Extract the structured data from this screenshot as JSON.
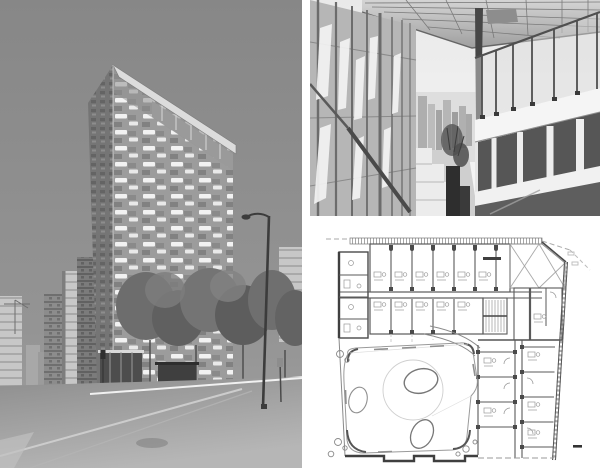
{
  "page": {
    "title": "Architecture project photo collage",
    "background": "#ffffff",
    "layout": "three-panel montage: street photo of tower (left), terrace facade photo (top right), floor plan drawing (bottom right)"
  },
  "panels": {
    "tower_photo": {
      "alt": "Black-and-white photograph of a tall residential tower seen corner-on against a grey sky; its facade is a checkerboard of openings with scattered white balcony slabs and a cantilevered white roof visor. At street level there are trees, neighbouring apartment towers on the left, a bus shelter, a street lamp on the right and an empty asphalt road in the foreground.",
      "palette": {
        "sky": "#8d8d8d",
        "facade": "#9c9c9c",
        "facade_shadow": "#757575",
        "balcony": "#f4f4f4",
        "trees": "#676767",
        "road": "#a3a3a3",
        "sidewalk": "#e3e3e3"
      }
    },
    "terrace_photo": {
      "alt": "Black-and-white photograph looking along a rooftop terrace: a glazed curtain wall with twisted white screen panels on the left, a gridded glass canopy overhead, a glass guardrail and white parapet with dark glazing on the right, potted plants and a distant city skyline in the centre.",
      "palette": {
        "sky": "#efefef",
        "canopy": "#b9b9b9",
        "frame": "#4a4a4a",
        "glass": "#dcdcdc",
        "parapet": "#f4f4f4",
        "glazing_dark": "#565656"
      }
    },
    "floor_plan": {
      "alt": "Architectural floor plan: two bars of small apartment units along the top separated by a corridor, a cross-braced void at the top right corner, a slanted hatched party wall on the right, an L-shaped block of units at the lower right, and a landscaped courtyard at the lower left with an organic rounded boundary, a large faint circle and three oval ponds, small tree circles at its corners.",
      "palette": {
        "paper": "#ffffff",
        "wall": "#4a4a4a",
        "line": "#8a8a8a",
        "faint": "#c9c9c9"
      }
    }
  }
}
